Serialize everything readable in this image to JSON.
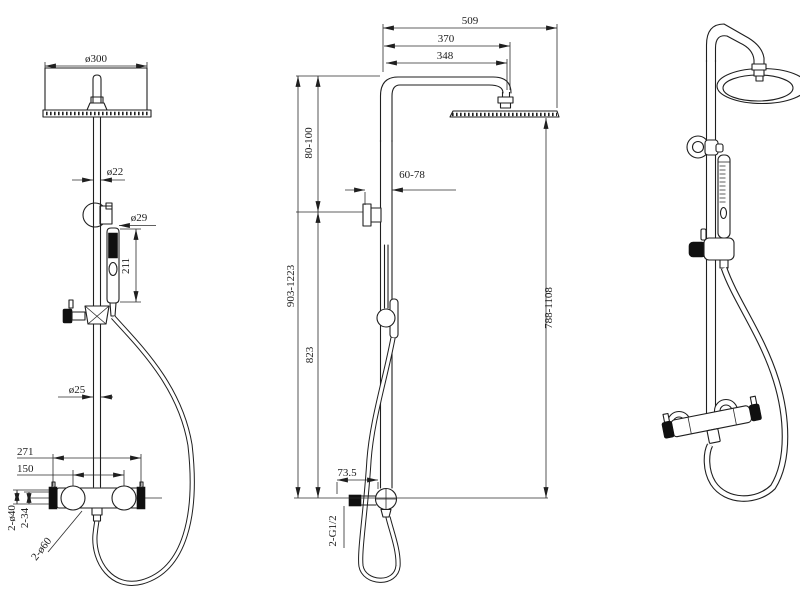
{
  "drawing_type": "shower-column-technical-drawing",
  "front_view": {
    "head_diameter": "ø300",
    "upper_pipe_diameter": "ø22",
    "handshower_diameter": "ø29",
    "handshower_length": "211",
    "lower_pipe_diameter": "ø25",
    "valve_overall_width": "271",
    "valve_center_distance": "150",
    "wall_flange": "2-ø40",
    "flange_depth": "2-34",
    "handle_diameter": "2-ø60"
  },
  "side_view": {
    "overall_projection": "509",
    "arm_projection": "370",
    "arm_length": "348",
    "top_to_bracket": "80-100",
    "wall_to_pipe": "60-78",
    "overall_height": "903-1223",
    "bracket_to_valve": "823",
    "outlet_offset": "73.5",
    "inlet_thread": "2-G1/2",
    "head_to_valve_height": "788-1108"
  },
  "colors": {
    "background": "#ffffff",
    "line": "#1f1f1f",
    "solid_fill": "#101010"
  }
}
